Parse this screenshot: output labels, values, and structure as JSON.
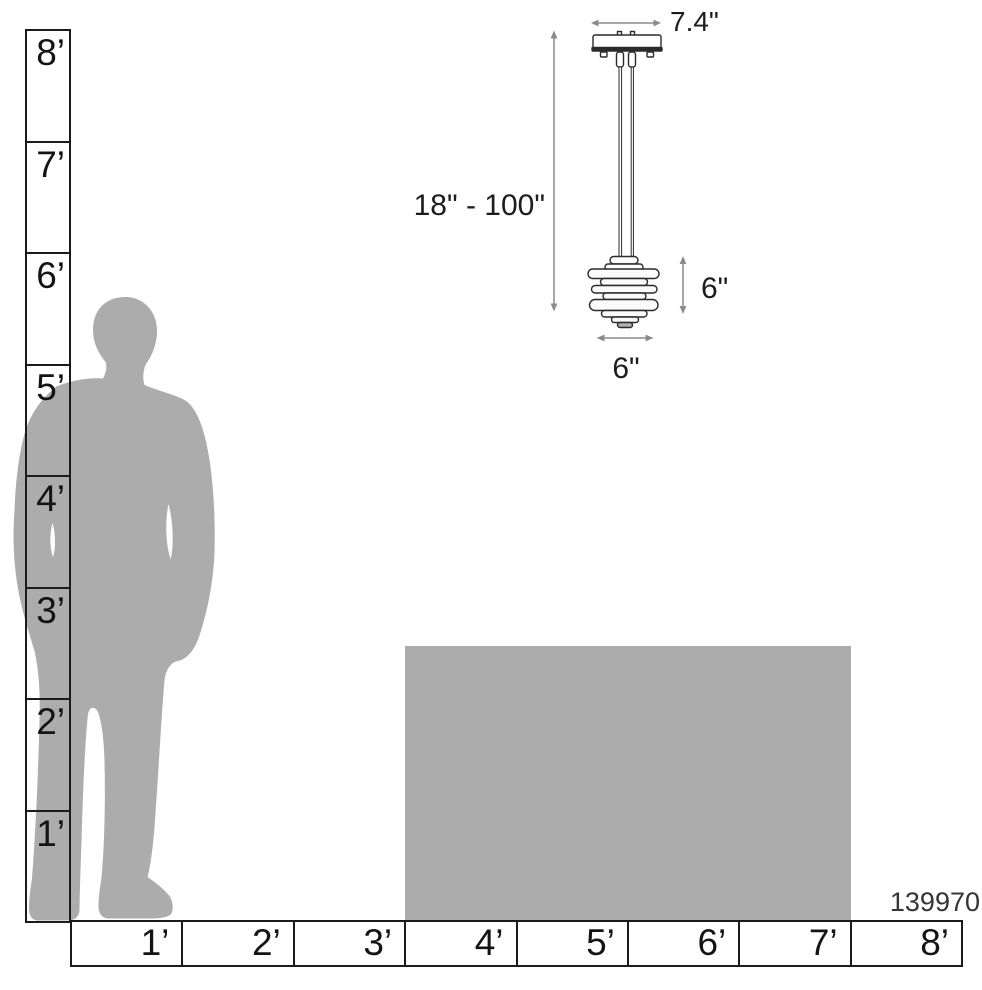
{
  "product": {
    "number": "139970"
  },
  "pendant": {
    "canopy_width_label": "7.4\"",
    "suspension_height_label": "18\" - 100\"",
    "fixture_height_label": "6\"",
    "fixture_width_label": "6\""
  },
  "vertical_ruler": {
    "unit": "feet",
    "labels": [
      "8’",
      "7’",
      "6’",
      "5’",
      "4’",
      "3’",
      "2’",
      "1’"
    ]
  },
  "horizontal_ruler": {
    "unit": "feet",
    "labels": [
      "1’",
      "2’",
      "3’",
      "4’",
      "5’",
      "6’",
      "7’",
      "8’"
    ]
  },
  "colors": {
    "silhouette_gray": "#ACACAC",
    "table_gray": "#ACACAC",
    "arrow_gray": "#8B8B8B",
    "ruler_border": "#1B1B1B",
    "text": "#1C1C1C"
  }
}
